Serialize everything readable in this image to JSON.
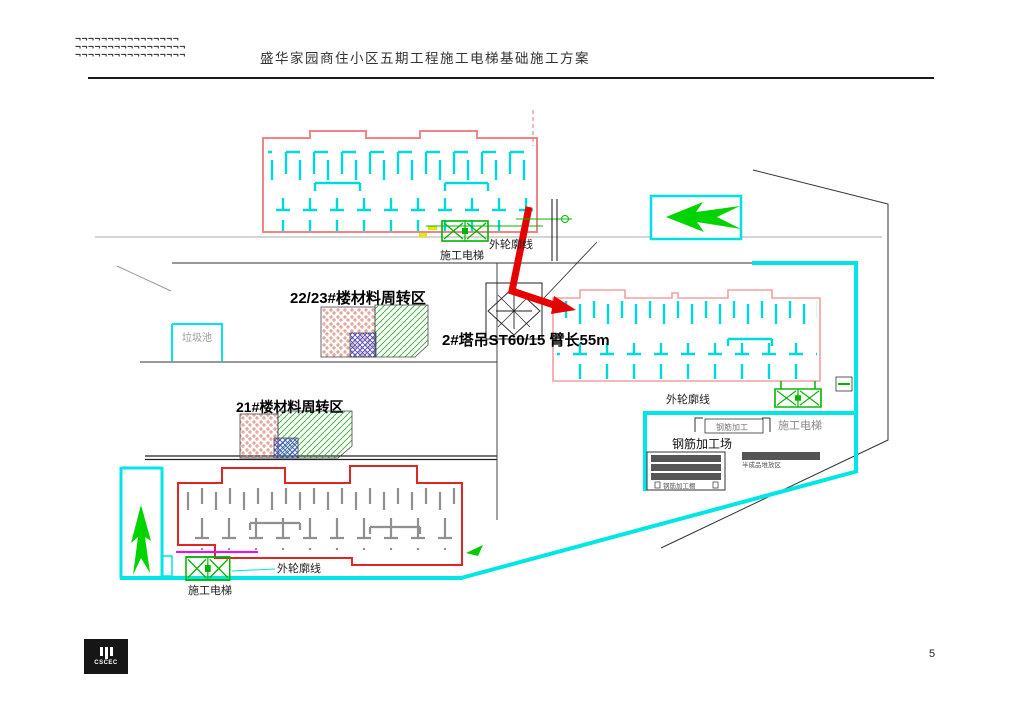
{
  "header": {
    "logo_row1": "¬¬¬¬¬¬¬¬¬¬¬¬¬¬¬¬",
    "logo_row2": "¬¬¬¬¬¬¬¬¬¬¬¬¬¬¬¬¬",
    "logo_row3": "¬¬¬¬¬¬¬¬¬¬¬¬¬¬¬¬¬",
    "title": "盛华家园商住小区五期工程施工电梯基础施工方案"
  },
  "footer": {
    "logo_text": "CSCEC",
    "page_number": "5"
  },
  "plan": {
    "labels": {
      "hoist_top": "施工电梯",
      "outline_top": "外轮廓线",
      "zone_2223": "22/23#楼材料周转区",
      "crane_label": "2#塔吊ST60/15 臂长55m",
      "garbage_pit": "垃圾池",
      "zone_21": "21#楼材料周转区",
      "outline_right": "外轮廓线",
      "hoist_right": "施工电梯",
      "rebar_box": "钢筋加工",
      "rebar_yard": "钢筋加工场",
      "rebar_note_right": "半成品堆放区",
      "rebar_note_bottom": "钢筋加工棚",
      "outline_bottom": "外轮廓线",
      "hoist_bottom": "施工电梯"
    },
    "colors": {
      "wall_cyan": "#00d9d9",
      "boundary_cyan": "#00e5e5",
      "outline_salmon": "#ef8585",
      "outline_red": "#e02525",
      "crane_red": "#e60000",
      "hoist_green": "#00b400",
      "arrow_green": "#00d400",
      "magenta": "#ff00ff",
      "wall_gray": "#909090"
    }
  }
}
